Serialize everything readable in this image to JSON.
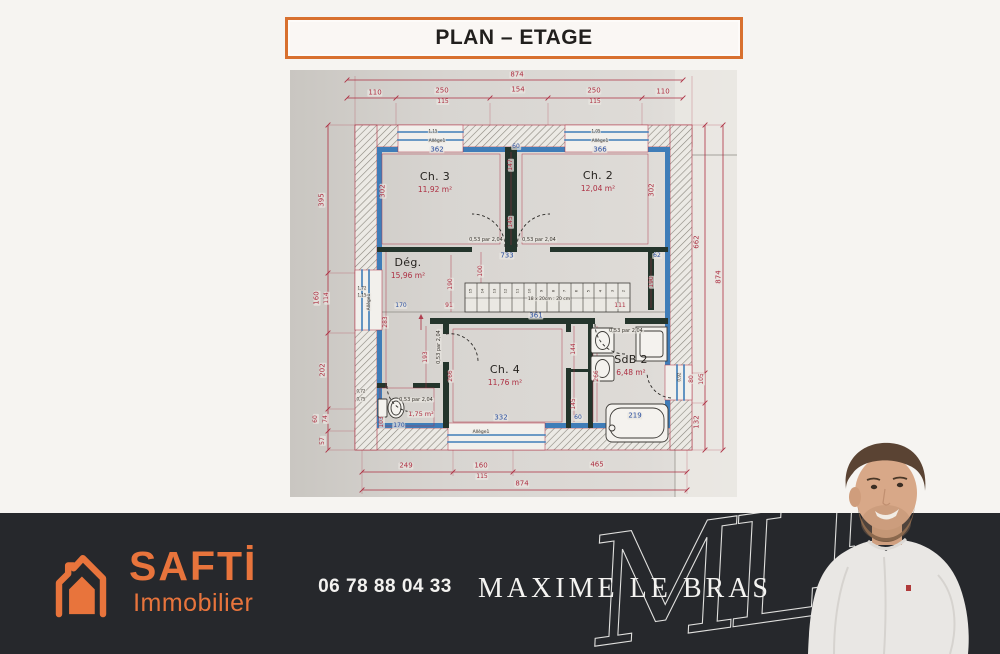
{
  "title": {
    "text": "PLAN – ETAGE"
  },
  "footer": {
    "phone": "06 78 88 04 33",
    "agent_name": "MAXIME LE BRAS",
    "monogram": "MLB",
    "brand_name": "SAFTİ",
    "brand_tagline": "Immobilier",
    "colors": {
      "bar_bg": "#26282c",
      "brand_orange": "#e8743c"
    }
  },
  "plan": {
    "colors": {
      "dim_red": "#ad2f42",
      "dim_blue": "#2a4fa0",
      "wall_blue": "#3f7db8"
    },
    "rooms": [
      {
        "name": "Ch. 3",
        "area": "11,92 m²",
        "x": 145,
        "y": 112
      },
      {
        "name": "Ch. 2",
        "area": "12,04 m²",
        "x": 308,
        "y": 111
      },
      {
        "name": "Dég.",
        "area": "15,96 m²",
        "x": 118,
        "y": 198
      },
      {
        "name": "Ch. 4",
        "area": "11,76 m²",
        "x": 215,
        "y": 305
      },
      {
        "name": "SdB 2",
        "area": "6,48 m²",
        "x": 341,
        "y": 295
      }
    ],
    "stairs": {
      "note": "18 x 20cm : 20 cm",
      "label": "361",
      "steps": [
        "15",
        "14",
        "13",
        "12",
        "11",
        "10",
        "9",
        "8",
        "7",
        "6",
        "5",
        "4",
        "3",
        "2"
      ]
    },
    "labels": [
      {
        "t": "874",
        "x": 227,
        "y": 5
      },
      {
        "t": "110",
        "x": 85,
        "y": 23
      },
      {
        "t": "250",
        "x": 152,
        "y": 21
      },
      {
        "t": "115",
        "x": 153,
        "y": 32,
        "s": 6
      },
      {
        "t": "154",
        "x": 228,
        "y": 20
      },
      {
        "t": "250",
        "x": 304,
        "y": 21
      },
      {
        "t": "115",
        "x": 305,
        "y": 32,
        "s": 6
      },
      {
        "t": "110",
        "x": 373,
        "y": 22
      },
      {
        "t": "395",
        "x": 32,
        "y": 130,
        "r": 1
      },
      {
        "t": "160",
        "x": 27,
        "y": 228,
        "r": 1
      },
      {
        "t": "114",
        "x": 37,
        "y": 228,
        "r": 1,
        "s": 6
      },
      {
        "t": "202",
        "x": 33,
        "y": 300,
        "r": 1
      },
      {
        "t": "60",
        "x": 26,
        "y": 349,
        "r": 1,
        "s": 6
      },
      {
        "t": "74",
        "x": 36,
        "y": 349,
        "r": 1,
        "s": 6
      },
      {
        "t": "57",
        "x": 33,
        "y": 371,
        "r": 1,
        "s": 6
      },
      {
        "t": "662",
        "x": 407,
        "y": 172,
        "r": 1
      },
      {
        "t": "874",
        "x": 429,
        "y": 207,
        "r": 1
      },
      {
        "t": "80",
        "x": 402,
        "y": 309,
        "r": 1,
        "s": 6
      },
      {
        "t": "105",
        "x": 412,
        "y": 309,
        "r": 1,
        "s": 6
      },
      {
        "t": "132",
        "x": 407,
        "y": 352,
        "r": 1
      },
      {
        "t": "249",
        "x": 116,
        "y": 396
      },
      {
        "t": "160",
        "x": 191,
        "y": 396
      },
      {
        "t": "115",
        "x": 192,
        "y": 407,
        "s": 6
      },
      {
        "t": "465",
        "x": 307,
        "y": 395
      },
      {
        "t": "874",
        "x": 232,
        "y": 414
      },
      {
        "t": "302",
        "x": 93,
        "y": 121,
        "r": 1
      },
      {
        "t": "302",
        "x": 362,
        "y": 120,
        "r": 1
      },
      {
        "t": "147",
        "x": 221,
        "y": 95,
        "r": 1,
        "s": 6
      },
      {
        "t": "145",
        "x": 221,
        "y": 152,
        "r": 1,
        "s": 6
      },
      {
        "t": "100",
        "x": 191,
        "y": 201,
        "r": 1,
        "s": 6
      },
      {
        "t": "190",
        "x": 161,
        "y": 214,
        "r": 1,
        "s": 6
      },
      {
        "t": "190",
        "x": 362,
        "y": 212,
        "r": 1,
        "s": 6
      },
      {
        "t": "283",
        "x": 96,
        "y": 252,
        "r": 1,
        "s": 6
      },
      {
        "t": "193",
        "x": 136,
        "y": 287,
        "r": 1,
        "s": 6
      },
      {
        "t": "266",
        "x": 161,
        "y": 306,
        "r": 1,
        "s": 6
      },
      {
        "t": "144",
        "x": 284,
        "y": 279,
        "r": 1,
        "s": 6
      },
      {
        "t": "266",
        "x": 307,
        "y": 306,
        "r": 1,
        "s": 6
      },
      {
        "t": "145",
        "x": 284,
        "y": 334,
        "r": 1,
        "s": 6
      },
      {
        "t": "103",
        "x": 92,
        "y": 352,
        "r": 1,
        "s": 6
      },
      {
        "t": "111",
        "x": 330,
        "y": 236,
        "s": 6
      },
      {
        "t": "91",
        "x": 159,
        "y": 236,
        "s": 6
      },
      {
        "t": "362",
        "x": 147,
        "y": 80,
        "c": "b"
      },
      {
        "t": "366",
        "x": 310,
        "y": 80,
        "c": "b"
      },
      {
        "t": "60",
        "x": 226,
        "y": 77,
        "c": "b",
        "s": 6
      },
      {
        "t": "733",
        "x": 217,
        "y": 186,
        "c": "b"
      },
      {
        "t": "62",
        "x": 367,
        "y": 186,
        "c": "b",
        "s": 6
      },
      {
        "t": "361",
        "x": 246,
        "y": 246,
        "c": "b"
      },
      {
        "t": "170",
        "x": 111,
        "y": 236,
        "c": "b",
        "s": 6
      },
      {
        "t": "332",
        "x": 211,
        "y": 348,
        "c": "b"
      },
      {
        "t": "60",
        "x": 288,
        "y": 348,
        "c": "b",
        "s": 6
      },
      {
        "t": "219",
        "x": 345,
        "y": 346,
        "c": "b"
      },
      {
        "t": "170",
        "x": 109,
        "y": 356,
        "c": "b",
        "s": 6
      },
      {
        "t": "0,53 par 2,04",
        "x": 196,
        "y": 170,
        "c": "d",
        "s": 5
      },
      {
        "t": "0,53 par 2,04",
        "x": 249,
        "y": 170,
        "c": "d",
        "s": 5
      },
      {
        "t": "0,53 par 2,04",
        "x": 126,
        "y": 330,
        "c": "d",
        "s": 5
      },
      {
        "t": "0,53 par 2,04",
        "x": 149,
        "y": 277,
        "c": "d",
        "s": 5,
        "r": 1
      },
      {
        "t": "0,53 par 2,04",
        "x": 336,
        "y": 261,
        "c": "d",
        "s": 5
      },
      {
        "t": "Allège1",
        "x": 147,
        "y": 71,
        "c": "d",
        "s": 4.5
      },
      {
        "t": "Allège1",
        "x": 310,
        "y": 71,
        "c": "d",
        "s": 4.5
      },
      {
        "t": "Allège1",
        "x": 191,
        "y": 362,
        "c": "d",
        "s": 4.5
      },
      {
        "t": "Allège1",
        "x": 79,
        "y": 232,
        "c": "d",
        "s": 4.5,
        "r": 1
      },
      {
        "t": "1,72",
        "x": 72,
        "y": 219,
        "c": "d",
        "s": 4
      },
      {
        "t": "1,15",
        "x": 72,
        "y": 226,
        "c": "d",
        "s": 4
      },
      {
        "t": "0,72",
        "x": 71,
        "y": 322,
        "c": "d",
        "s": 4
      },
      {
        "t": "0,75",
        "x": 71,
        "y": 330,
        "c": "d",
        "s": 4
      },
      {
        "t": "1,15",
        "x": 143,
        "y": 62,
        "c": "d",
        "s": 4
      },
      {
        "t": "1,05",
        "x": 306,
        "y": 62,
        "c": "d",
        "s": 4
      },
      {
        "t": "0,92",
        "x": 390,
        "y": 307,
        "c": "d",
        "s": 4,
        "r": 1
      },
      {
        "t": "18 x 20cm : 20 cm",
        "x": 259,
        "y": 229,
        "c": "d",
        "s": 4.5
      },
      {
        "t": "1,75 m²",
        "x": 131,
        "y": 344,
        "s": 6.5
      }
    ]
  }
}
